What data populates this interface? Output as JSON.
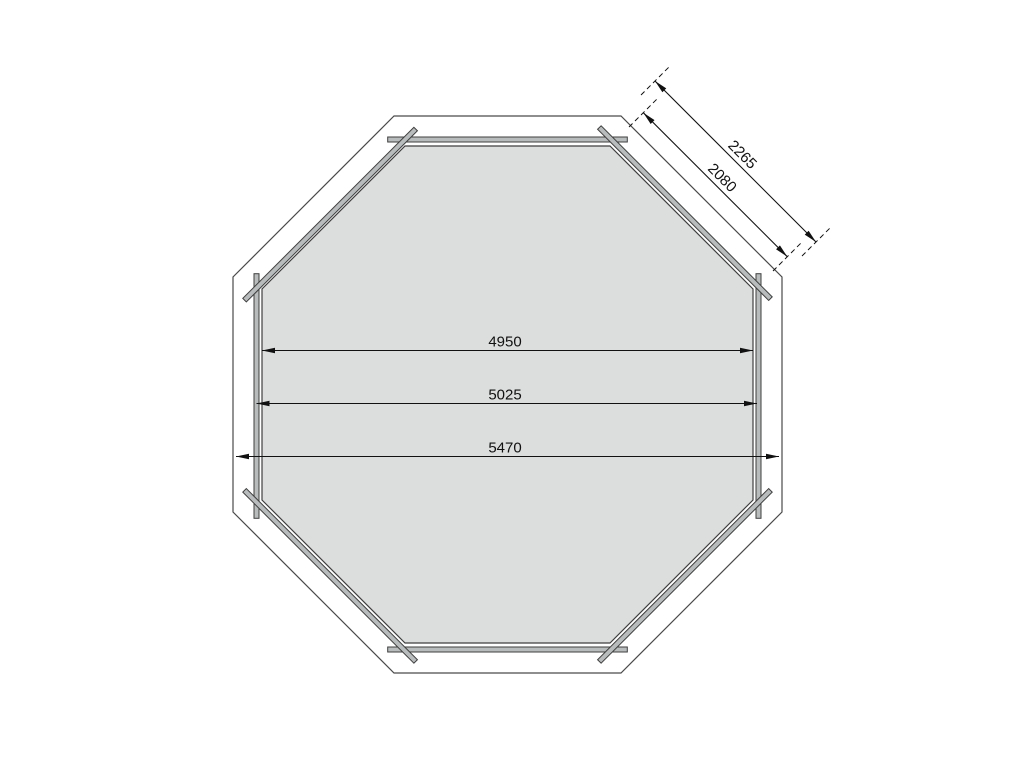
{
  "drawing": {
    "kind": "octagonal floor plan, top view",
    "dimensions": {
      "horizontal": [
        {
          "name": "inner-floor-width",
          "label": "4950"
        },
        {
          "name": "wall-outer-width",
          "label": "5025"
        },
        {
          "name": "overall-width",
          "label": "5470"
        }
      ],
      "diagonal": [
        {
          "name": "outer-facet-length",
          "label": "2265"
        },
        {
          "name": "inner-facet-length",
          "label": "2080"
        }
      ]
    },
    "colors": {
      "background": "#ffffff",
      "floor_fill": "#dcdddd",
      "plank_fill": "#b8bcbc",
      "outline": "#454545",
      "dimension_line": "#111111"
    }
  }
}
